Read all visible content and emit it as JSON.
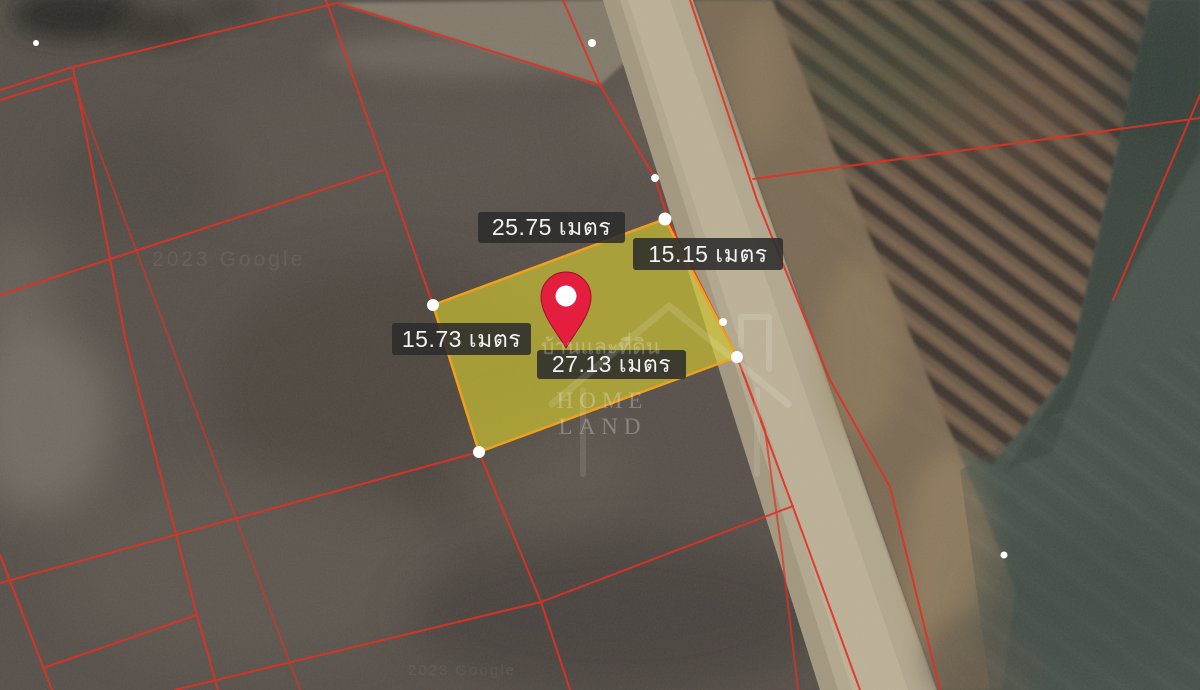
{
  "map": {
    "measurement_labels": {
      "top": "25.75 เมตร",
      "right": "15.15 เมตร",
      "left": "15.73 เมตร",
      "bottom": "27.13 เมตร"
    },
    "watermark": {
      "brand_latin": "HOME LAND",
      "brand_thai": "บ้านและที่ดิน"
    },
    "imagery_credit": "2023 Google",
    "colors": {
      "parcel_fill": "#d8cf2e",
      "parcel_border": "#efa01e",
      "cadastral_line": "#e23024",
      "label_background": "#2c2c2c",
      "label_text": "#f3f3f3",
      "pin_red": "#e41e3e",
      "road_tan": "#b2a78e"
    }
  }
}
